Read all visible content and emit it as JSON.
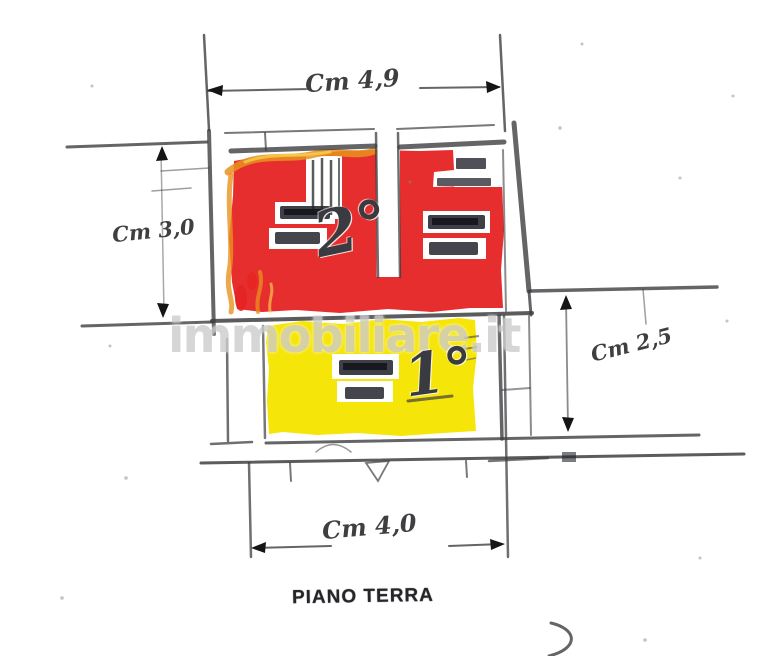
{
  "floorplan": {
    "caption": "PIANO TERRA",
    "watermark": "immobiliare.it",
    "dimensions": {
      "top": "Cm 4,9",
      "left": "Cm 3,0",
      "right": "Cm 2,5",
      "bottom": "Cm 4,0"
    },
    "units": [
      {
        "id": "unit-2",
        "label": "2°",
        "highlight": "red"
      },
      {
        "id": "unit-1",
        "label": "1°",
        "highlight": "yellow"
      }
    ]
  },
  "colors": {
    "paper": "#ffffff",
    "pencil": "#3f3f42",
    "red_highlight": "#e62323",
    "yellow_highlight": "#f6e400",
    "orange_marker": "#e8921e",
    "watermark": "#cdcdcd",
    "stamp": "#23242e"
  }
}
